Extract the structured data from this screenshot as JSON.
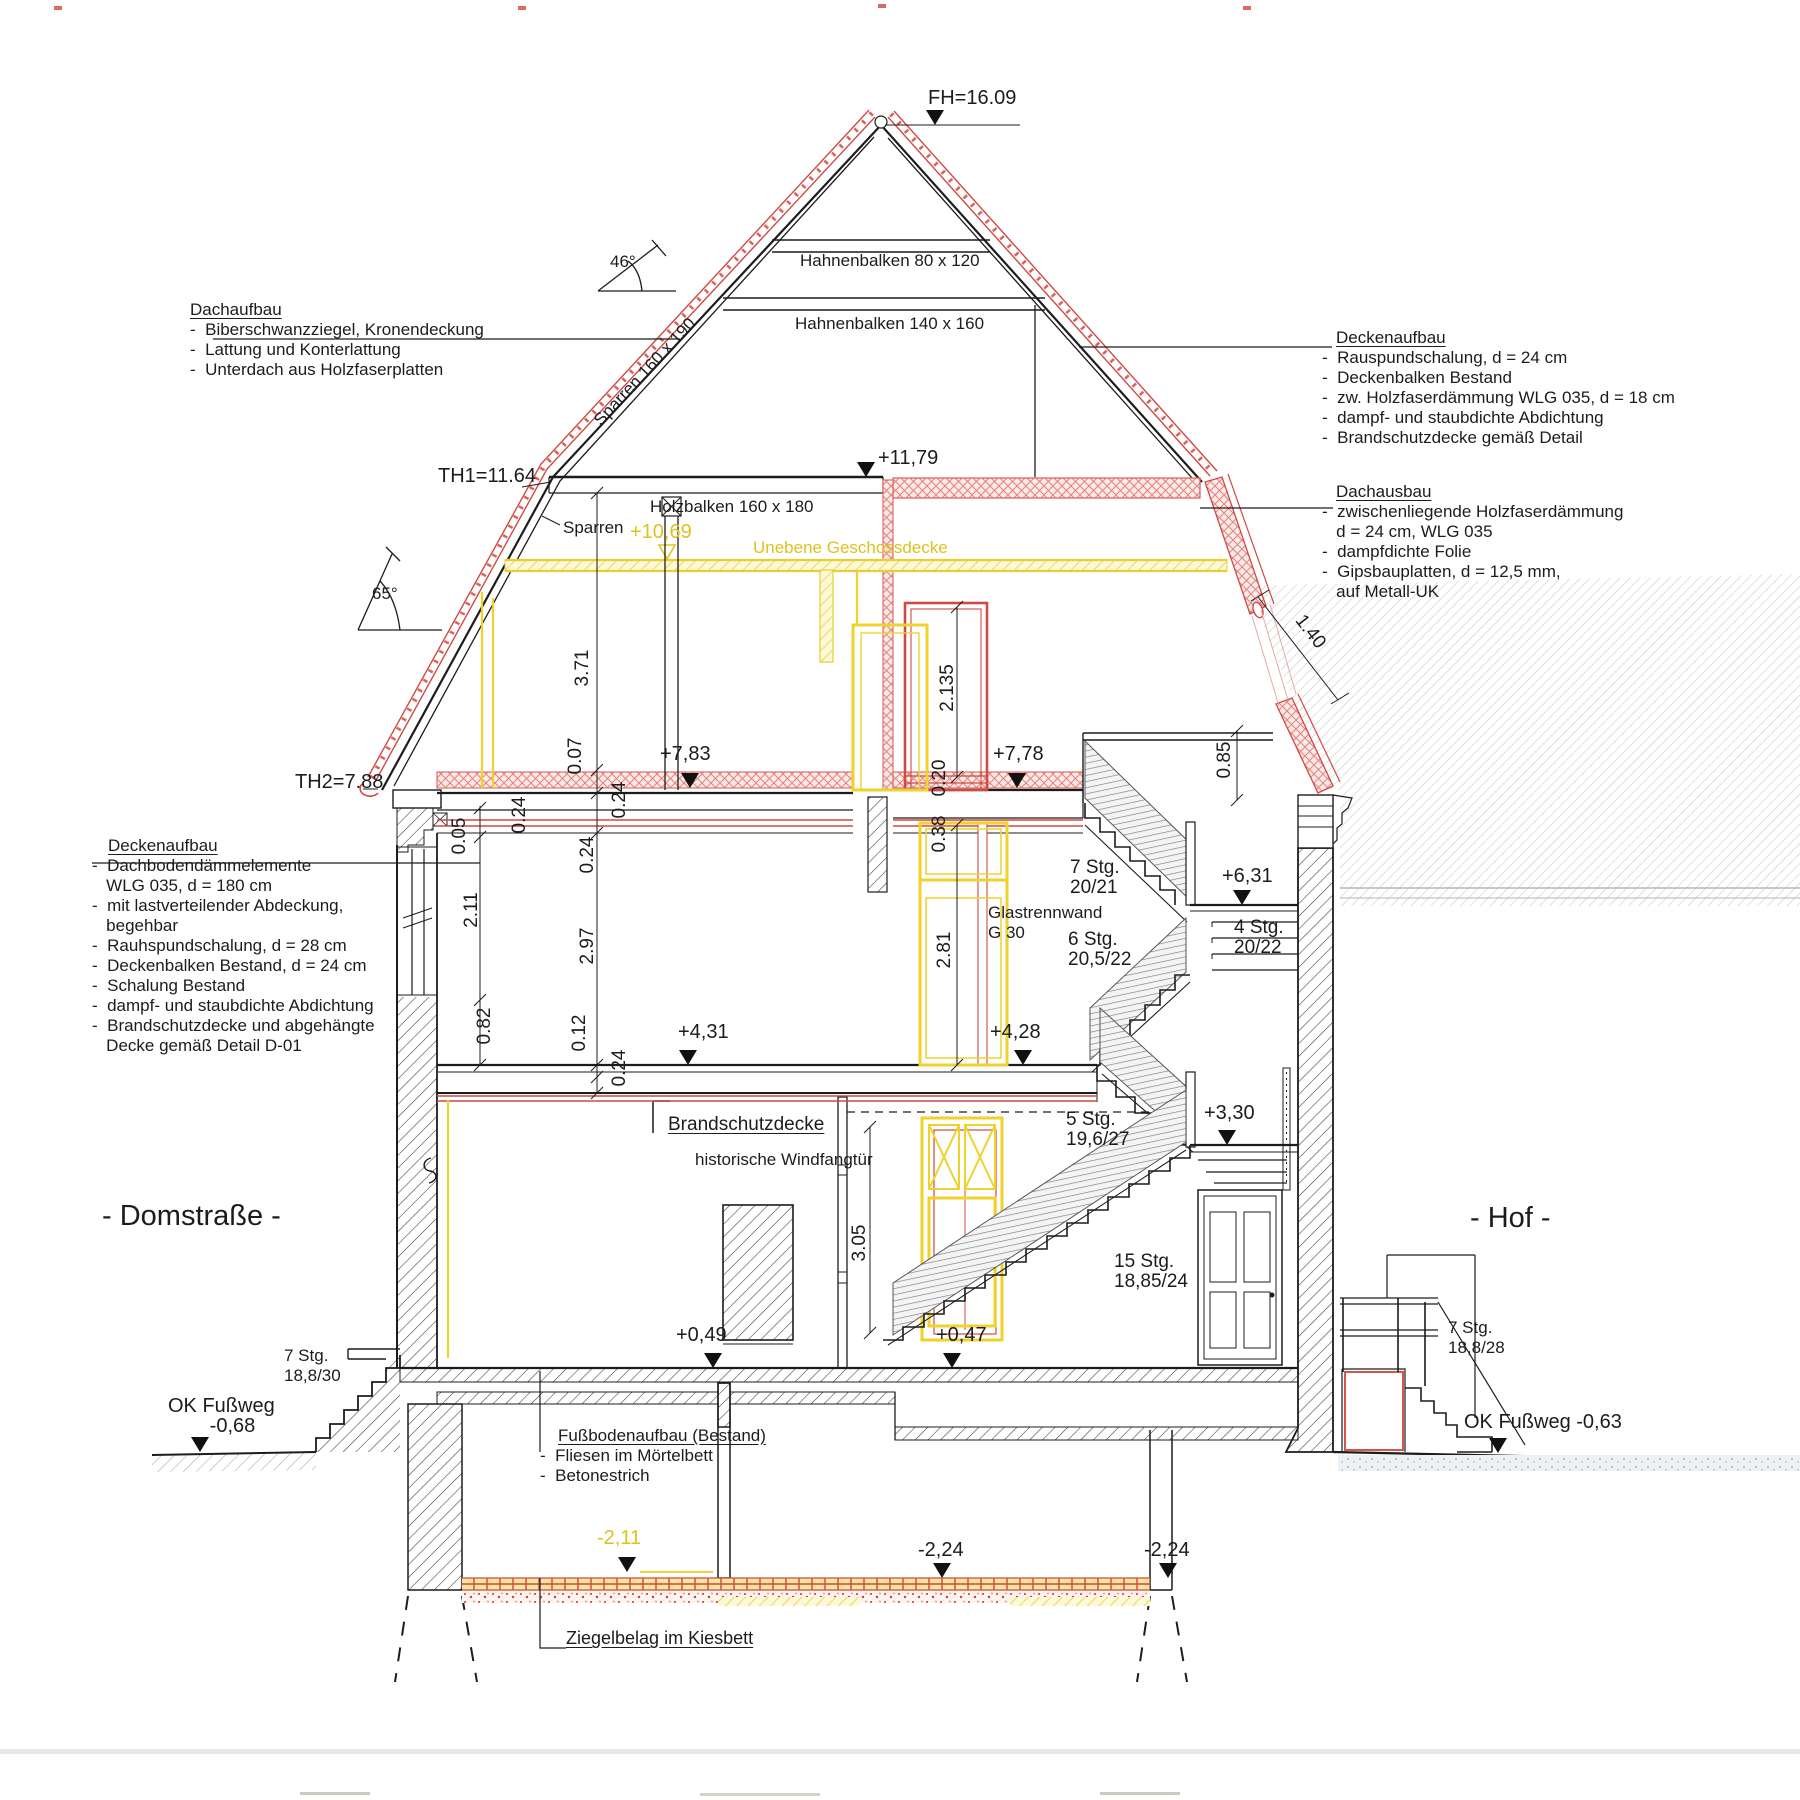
{
  "roof": {
    "fh": "FH=16.09",
    "angle_top": "46°",
    "angle_side": "65°",
    "hahnenbalken_1": "Hahnenbalken 80 x 120",
    "hahnenbalken_2": "Hahnenbalken 140 x 160",
    "sparren_rot": "Sparren 160 x 190",
    "sparren": "Sparren",
    "holzbalken": "Holzbalken 160 x 180",
    "th1": "TH1=11.64",
    "th2": "TH2=7.88"
  },
  "levels": {
    "l1179": "+11,79",
    "l1069": "+10,69",
    "l783": "+7,83",
    "l778": "+7,78",
    "l631": "+6,31",
    "l431": "+4,31",
    "l428": "+4,28",
    "l330": "+3,30",
    "l049": "+0,49",
    "l047": "+0,47",
    "lm211": "-2,11",
    "lm224a": "-2,24",
    "lm224b": "-2,24",
    "ok_left": "OK Fußweg\n    -0,68",
    "ok_right": "OK Fußweg -0,63"
  },
  "dims": {
    "d371": "3.71",
    "d2135": "2.135",
    "d007": "0.07",
    "d024a": "0.24",
    "d024b": "0.24",
    "d024c": "0.24",
    "d024d": "0.24",
    "d005": "0.05",
    "d211": "2.11",
    "d297": "2.97",
    "d020": "0.20",
    "d038": "0.38",
    "d281": "2.81",
    "d082": "0.82",
    "d012": "0.12",
    "d305": "3.05",
    "d085": "0.85",
    "d140": "1.40"
  },
  "stairs": {
    "s1": "7 Stg.\n20/21",
    "s2": "4 Stg.\n20/22",
    "s3": "6 Stg.\n20,5/22",
    "s4": "5 Stg.\n19,6/27",
    "s5": "15 Stg.\n18,85/24",
    "s6": "7 Stg.\n18,8/30",
    "s7": "7 Stg.\n18,8/28"
  },
  "notes": {
    "unebene": "Unebene Geschossdecke",
    "glastrennwand": "Glastrennwand\nG 30",
    "brandschutz": "Brandschutzdecke",
    "windfang": "historische Windfangtür",
    "ziegelbelag": "Ziegelbelag im Kiesbett"
  },
  "blocks": {
    "dachaufbau": {
      "title": "Dachaufbau",
      "items": [
        "-  Biberschwanzziegel, Kronendeckung",
        "-  Lattung und Konterlattung",
        "-  Unterdach aus Holzfaserplatten"
      ]
    },
    "decke_r": {
      "title": "Deckenaufbau",
      "items": [
        "-  Rauspundschalung, d = 24 cm",
        "-  Deckenbalken Bestand",
        "-  zw. Holzfaserdämmung WLG 035, d = 18 cm",
        "-  dampf- und staubdichte Abdichtung",
        "-  Brandschutzdecke gemäß Detail"
      ]
    },
    "dachausbau": {
      "title": "Dachausbau",
      "items": [
        "-  zwischenliegende Holzfaserdämmung",
        "   d = 24 cm, WLG 035",
        "-  dampfdichte Folie",
        "-  Gipsbauplatten, d = 12,5 mm,",
        "   auf Metall-UK"
      ]
    },
    "decke_l": {
      "title": "Deckenaufbau",
      "items": [
        "-  Dachbodendämmelemente",
        "   WLG 035, d = 180 cm",
        "-  mit lastverteilender Abdeckung,",
        "   begehbar",
        "-  Rauhspundschalung, d = 28 cm",
        "-  Deckenbalken Bestand, d = 24 cm",
        "-  Schalung Bestand",
        "-  dampf- und staubdichte Abdichtung",
        "-  Brandschutzdecke und abgehängte",
        "   Decke gemäß Detail D-01"
      ]
    },
    "fussboden": {
      "title": "Fußbodenaufbau (Bestand)",
      "items": [
        "-  Fliesen im Mörtelbett",
        "-  Betonestrich"
      ]
    }
  },
  "streets": {
    "left": "- Domstraße -",
    "right": "- Hof -"
  },
  "colors": {
    "accent_red": "#cf4a44",
    "accent_yellow": "#efd22c",
    "line": "#1c1c1c"
  }
}
